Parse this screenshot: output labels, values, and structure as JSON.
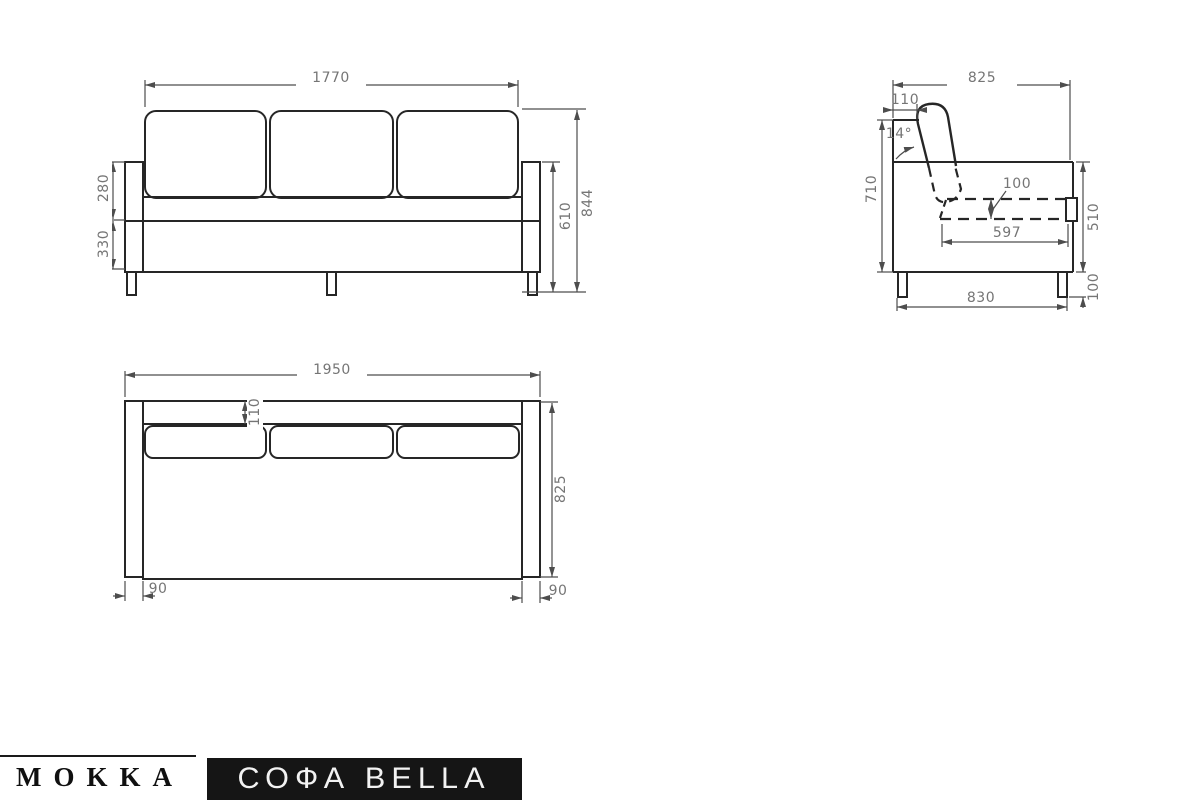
{
  "brand": {
    "name": "MOKKA",
    "product_label": "СОФА BELLA"
  },
  "views": {
    "front": {
      "label": "front-view",
      "dims": {
        "cushion_width": "1770",
        "backrest_height": "280",
        "base_height": "330",
        "armrest_height": "610",
        "total_height": "844"
      }
    },
    "side": {
      "label": "side-view",
      "dims": {
        "total_depth": "825",
        "backrest_thickness": "110",
        "backrest_angle": "14°",
        "height_to_top": "710",
        "cushion_thickness": "100",
        "seat_depth": "597",
        "body_side_height": "510",
        "base_depth": "830",
        "leg_height": "100"
      }
    },
    "top": {
      "label": "top-view",
      "dims": {
        "total_width": "1950",
        "back_rail_depth": "110",
        "total_depth": "825",
        "armrest_width_left": "90",
        "armrest_width_right": "90"
      }
    }
  },
  "colors": {
    "object_line": "#2a2a2a",
    "dimension_line": "#4d4d4d",
    "dimension_text": "#757575",
    "logo_bar_bg": "#151515",
    "logo_text": "#101010",
    "product_text": "#f2f2f2"
  }
}
